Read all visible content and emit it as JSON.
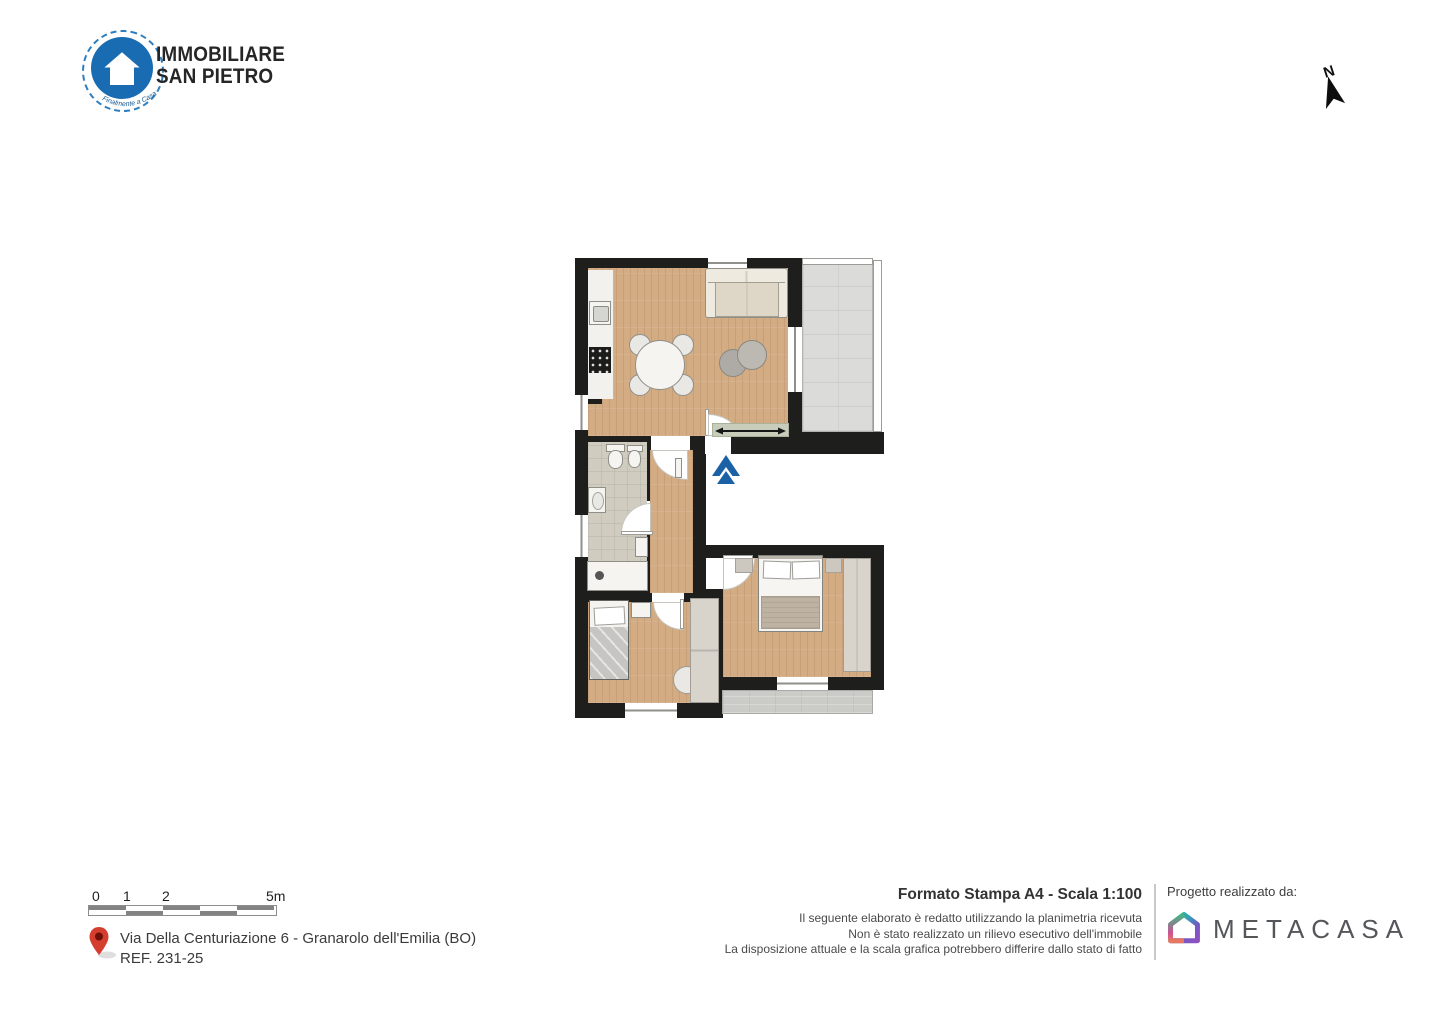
{
  "branding": {
    "name_line1": "IMMOBILIARE",
    "name_line2": "SAN PIETRO",
    "tagline": "Finalmente a Casa"
  },
  "compass": {
    "north_label": "N"
  },
  "scale_bar": {
    "labels": [
      "0",
      "1",
      "2",
      "5m"
    ]
  },
  "address": {
    "line1": "Via Della Centuriazione 6 - Granarolo dell'Emilia (BO)",
    "line2": "REF. 231-25"
  },
  "print_info": {
    "title": "Formato Stampa A4 - Scala 1:100",
    "disclaimer": [
      "Il seguente elaborato è redatto utilizzando la planimetria ricevuta",
      "Non è stato realizzato un rilievo esecutivo dell'immobile",
      "La disposizione attuale e la scala grafica potrebbero differire dallo stato di fatto"
    ]
  },
  "credits": {
    "label": "Progetto realizzato da:",
    "company": "METACASA"
  },
  "colors": {
    "wall": "#1e1e1c",
    "wood_floor": "#d3ac84",
    "balcony_tile": "#dbdbd9",
    "bathroom_floor": "#d0ccc0",
    "entrance_arrow_blue": "#1a61a5",
    "brand_blue": "#1a6cb2",
    "pin_red": "#d43e2e",
    "metacasa_gradient": [
      "#35b48b",
      "#2ea7b4",
      "#7459c5",
      "#e0518b",
      "#e8795f"
    ]
  }
}
